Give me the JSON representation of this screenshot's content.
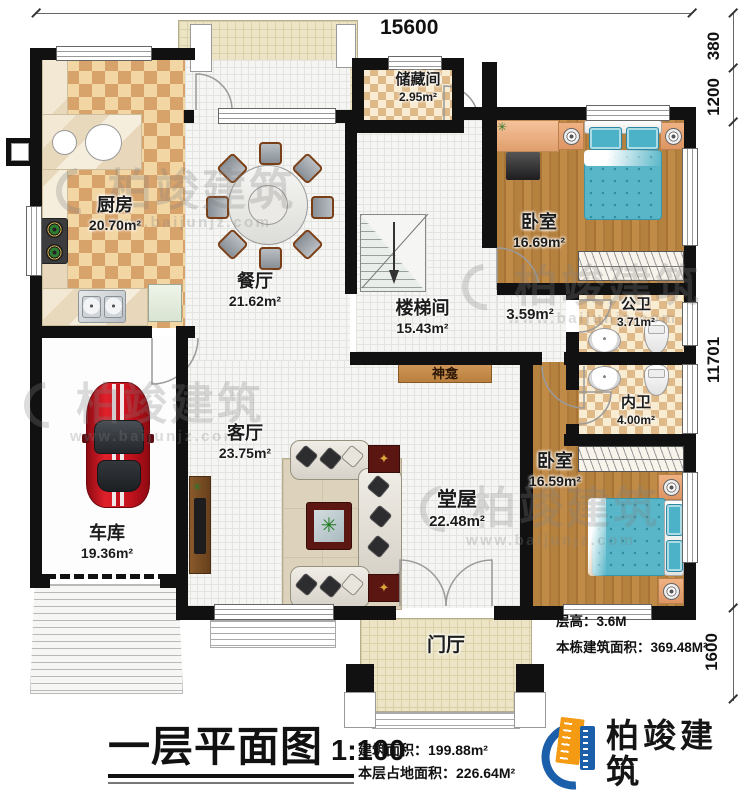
{
  "doc": {
    "type": "architectural floor plan",
    "floor": "first"
  },
  "dimensions": {
    "top": "15600",
    "right": [
      "380",
      "1200",
      "11701",
      "1600"
    ]
  },
  "rooms": {
    "kitchen": {
      "name": "厨房",
      "area": "20.70m²"
    },
    "storage": {
      "name": "储藏间",
      "area": "2.95m²"
    },
    "dining": {
      "name": "餐厅",
      "area": "21.62m²"
    },
    "bedroom_top": {
      "name": "卧室",
      "area": "16.69m²"
    },
    "stairwell": {
      "name": "楼梯间",
      "area": "15.43m²"
    },
    "corridor": {
      "area": "3.59m²"
    },
    "public_bath": {
      "name": "公卫",
      "area": "3.71m²"
    },
    "private_bath": {
      "name": "内卫",
      "area": "4.00m²"
    },
    "shrine": {
      "name": "神龛"
    },
    "living": {
      "name": "客厅",
      "area": "23.75m²"
    },
    "hall": {
      "name": "堂屋",
      "area": "22.48m²"
    },
    "bedroom_bottom": {
      "name": "卧室",
      "area": "16.59m²"
    },
    "garage": {
      "name": "车库",
      "area": "19.36m²"
    },
    "foyer": {
      "name": "门厅"
    }
  },
  "notes": {
    "floor_height": "层高：3.6M",
    "building_total_area": "本栋建筑面积：369.48M²"
  },
  "title_block": {
    "title": "一层平面图",
    "scale": "1:100",
    "floor_area": "建筑面积：199.88m²",
    "footprint_area": "本层占地面积：226.64M²"
  },
  "brand": {
    "name": "柏竣建筑",
    "website": "www.baijunjz.com"
  },
  "colors": {
    "wall": "#111111",
    "wood_floor": "#b5813f",
    "checker_dark": "#d8a36a",
    "checker_light": "#f2d6a4",
    "bed_blue": "#58b6c8",
    "car_red": "#c3121d",
    "logo_blue": "#1b5ea9",
    "logo_orange": "#f49a13"
  }
}
